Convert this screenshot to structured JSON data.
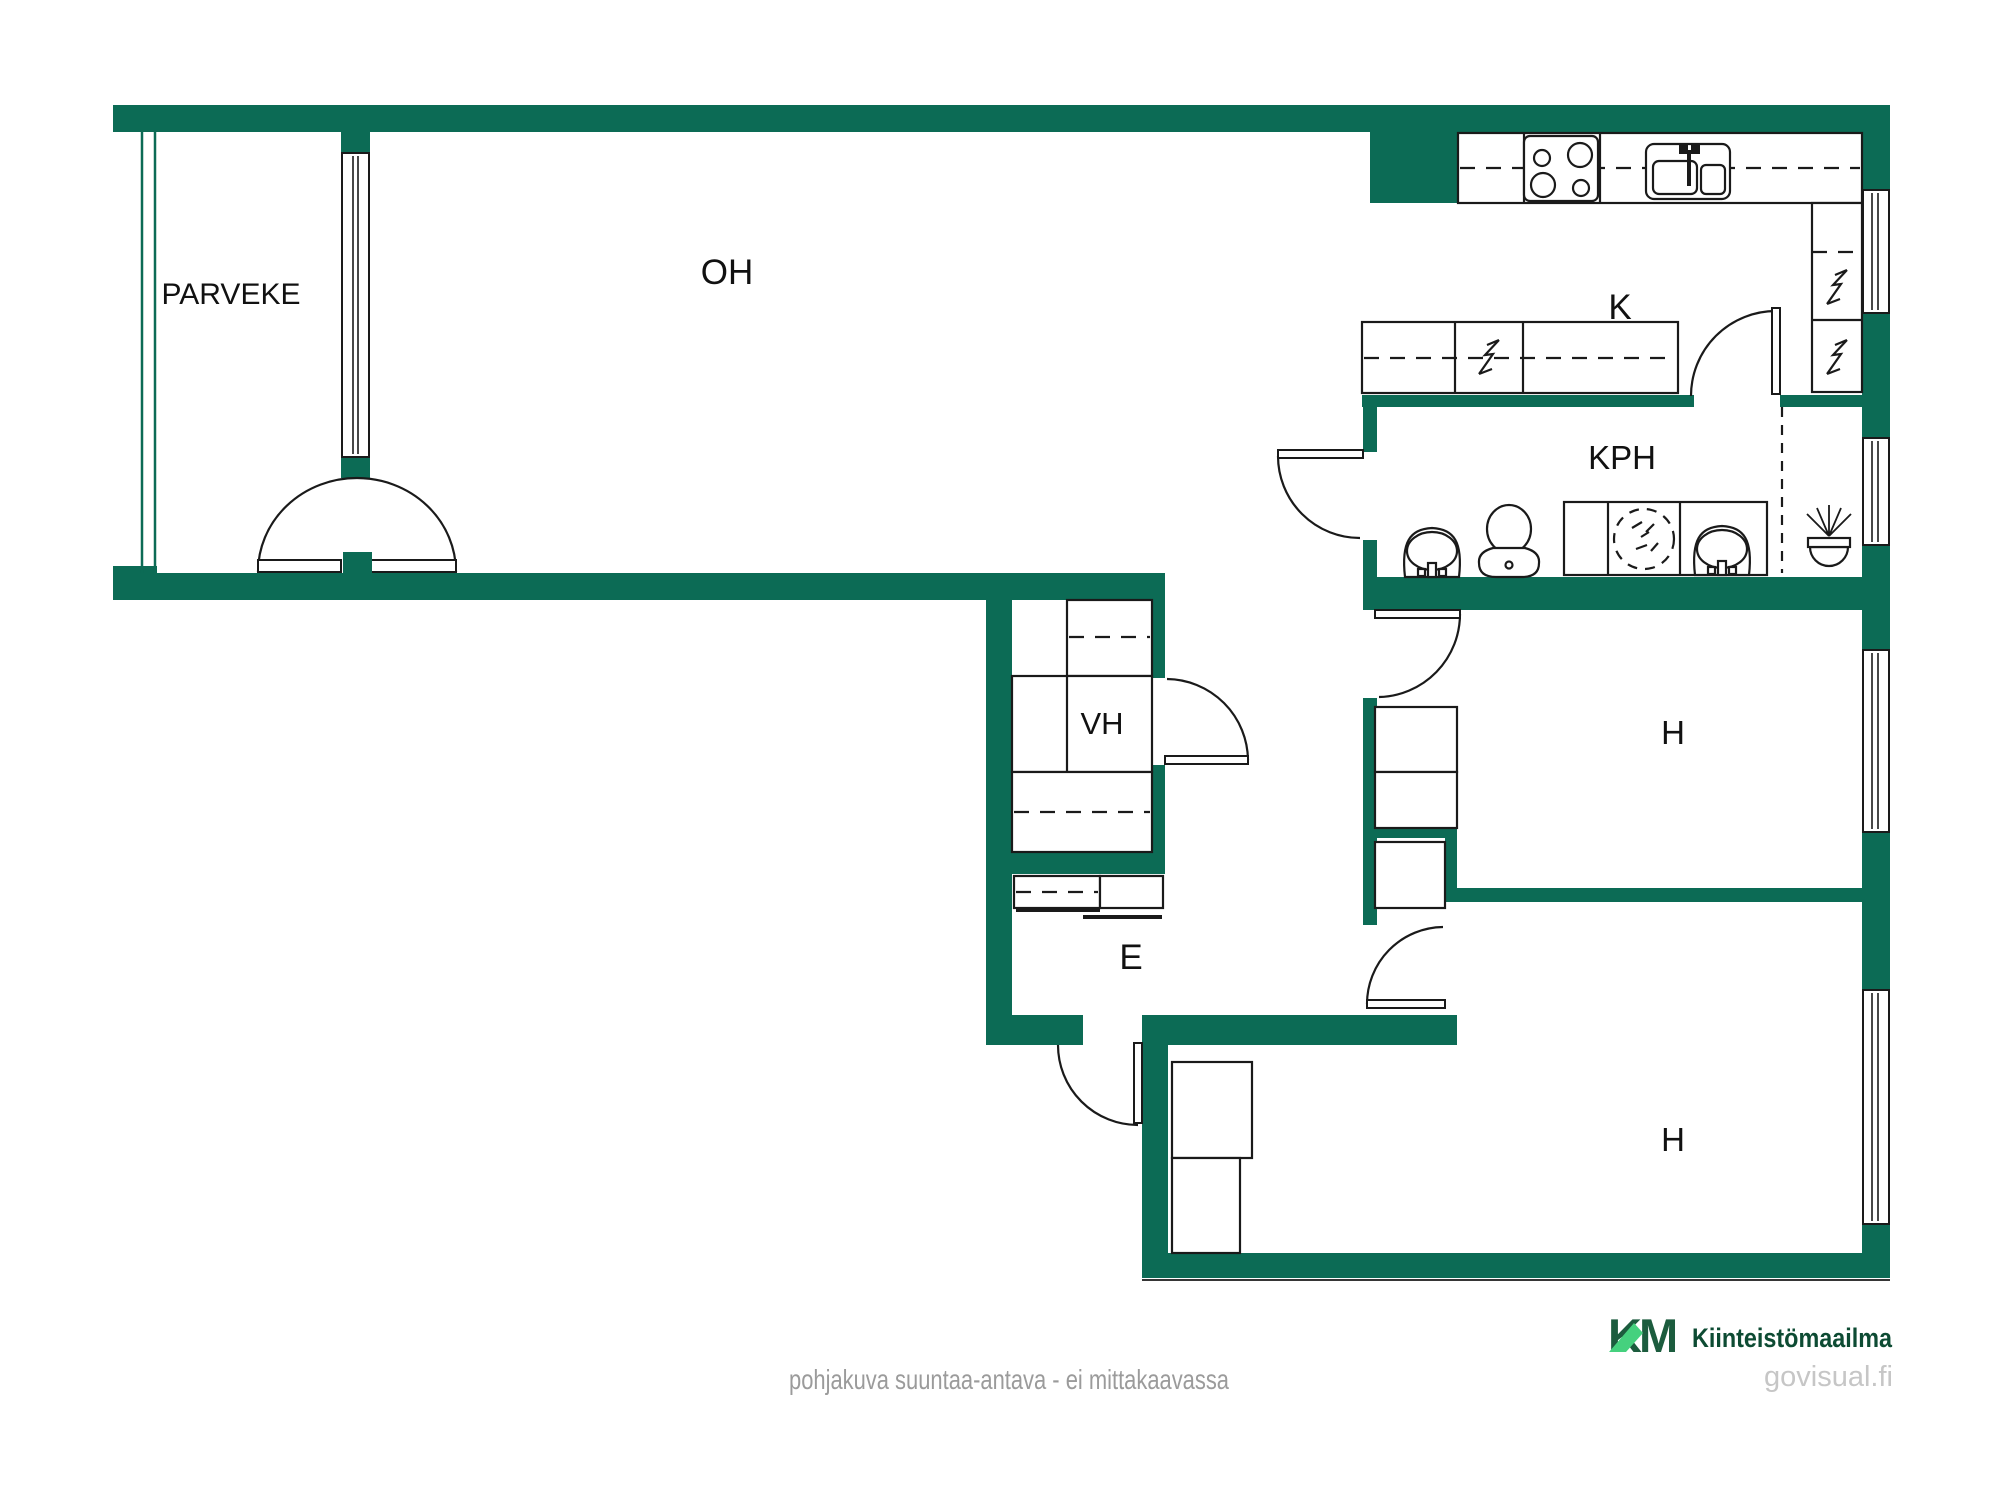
{
  "document": {
    "type": "floor-plan",
    "style": "real-estate marketing plan"
  },
  "rooms": {
    "parveke": {
      "label": "PARVEKE"
    },
    "oh": {
      "label": "OH"
    },
    "k": {
      "label": "K"
    },
    "kph": {
      "label": "KPH"
    },
    "vh": {
      "label": "VH"
    },
    "e": {
      "label": "E"
    },
    "h1": {
      "label": "H"
    },
    "h2": {
      "label": "H"
    }
  },
  "fixtures": [
    "stove",
    "kitchen-sink",
    "refrigerator-bolt",
    "dishwasher-bolt",
    "washbasin",
    "toilet",
    "washing-machine",
    "floor-drain",
    "wardrobe",
    "coat-rack",
    "door-swing",
    "window",
    "balcony-double-door"
  ],
  "footer": {
    "disclaimer": "pohjakuva suuntaa-antava - ei mittakaavassa",
    "logo_monogram": "KM",
    "brand": "Kiinteistömaailma",
    "watermark": "govisual.fi"
  },
  "colors": {
    "wall": "#0C6B55",
    "line": "#1A1A1A",
    "label": "#111111",
    "disclaimer": "#9B9B9B",
    "watermark": "#C6C6C6",
    "brand_dark": "#0D4B33",
    "logo_dark": "#1C5C3E",
    "logo_light": "#45D17E"
  }
}
